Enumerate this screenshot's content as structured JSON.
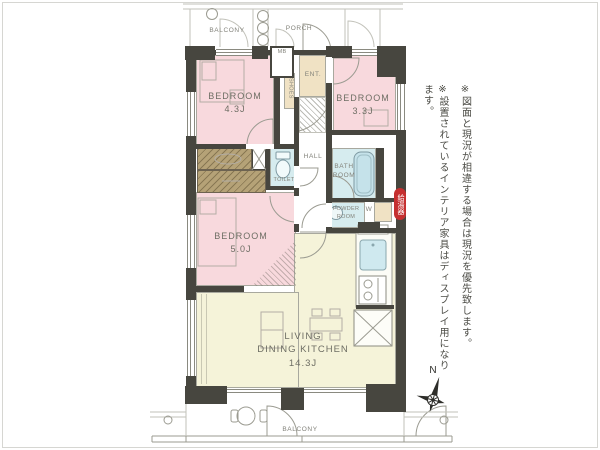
{
  "plan": {
    "rooms": {
      "balcony_top": {
        "label": "BALCONY"
      },
      "porch": {
        "label": "PORCH"
      },
      "entrance": {
        "label": "ENT."
      },
      "meter_box": {
        "label": "MB"
      },
      "shoes": {
        "label": "SHOES"
      },
      "bedroom_43": {
        "name": "BEDROOM",
        "size": "4.3J"
      },
      "bedroom_33": {
        "name": "BEDROOM",
        "size": "3.3J"
      },
      "bedroom_50": {
        "name": "BEDROOM",
        "size": "5.0J"
      },
      "hall": {
        "label": "HALL"
      },
      "toilet": {
        "label": "TOILET"
      },
      "bathroom": {
        "label": "BATH\nROOM"
      },
      "powder_room": {
        "label": "POWDER\nROOM"
      },
      "washer": {
        "label": "W"
      },
      "ldk": {
        "name": "LIVING\nDINING KITCHEN",
        "size": "14.3J"
      },
      "balcony_bottom": {
        "label": "BALCONY"
      }
    },
    "tags": {
      "water_heater": "給湯器"
    },
    "compass": {
      "north": "N"
    }
  },
  "notes": {
    "line1": "※図面と現況が相違する場合は現況を優先致します。",
    "line2": "※設置されているインテリア家具はディスプレイ用になります。"
  },
  "colors": {
    "room_pink": "#f8d9dd",
    "room_cream": "#f5f3d9",
    "room_blue": "#d6ecef",
    "room_tan": "#f0e2c4",
    "closet_brown": "#b5a277",
    "wall": "#47463f",
    "line": "#9b9b91",
    "text": "#6e6e64",
    "badge_red": "#c53030"
  }
}
